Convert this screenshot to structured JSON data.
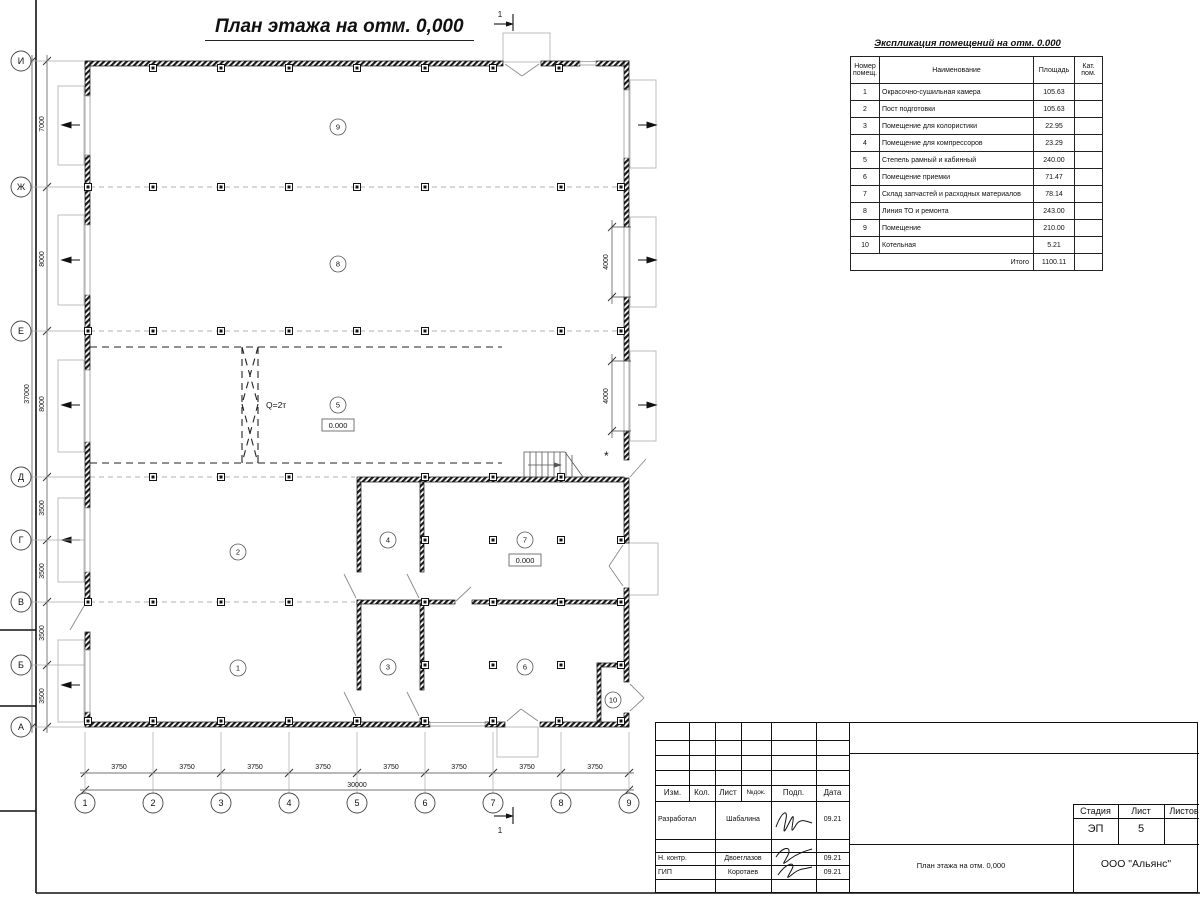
{
  "title": "План этажа на отм. 0,000",
  "section_mark": "1",
  "axes": {
    "left": [
      "И",
      "Ж",
      "Е",
      "Д",
      "Г",
      "В",
      "Б",
      "А"
    ],
    "bottom": [
      "1",
      "2",
      "3",
      "4",
      "5",
      "6",
      "7",
      "8",
      "9"
    ]
  },
  "dimensions": {
    "left_segments": [
      "7000",
      "8000",
      "8000",
      "3500",
      "3500",
      "3500",
      "3500"
    ],
    "left_total": "37000",
    "bottom_segments": [
      "3750",
      "3750",
      "3750",
      "3750",
      "3750",
      "3750",
      "3750",
      "3750"
    ],
    "bottom_total": "30000",
    "right_segments": [
      "4000",
      "4000"
    ]
  },
  "plan_labels": {
    "crane": "Q=2т",
    "level_marks": [
      "0.000",
      "0.000"
    ],
    "room_numbers": [
      "1",
      "2",
      "3",
      "4",
      "5",
      "6",
      "7",
      "8",
      "9",
      "10"
    ],
    "asterisk": "*"
  },
  "explication": {
    "title": "Экспликация помещений на отм. 0.000",
    "headers": [
      "Номер\nпомещ.",
      "Наименование",
      "Площадь",
      "Кат.\nпом."
    ],
    "rows": [
      {
        "num": "1",
        "name": "Окрасочно-сушильная камера",
        "area": "105.63"
      },
      {
        "num": "2",
        "name": "Пост подготовки",
        "area": "105.63"
      },
      {
        "num": "3",
        "name": "Помещение для колористики",
        "area": "22.95"
      },
      {
        "num": "4",
        "name": "Помещение для компрессоров",
        "area": "23.29"
      },
      {
        "num": "5",
        "name": "Степель рамный и кабинный",
        "area": "240.00"
      },
      {
        "num": "6",
        "name": "Помещение приемки",
        "area": "71.47"
      },
      {
        "num": "7",
        "name": "Склад запчастей и расходных материалов",
        "area": "78.14"
      },
      {
        "num": "8",
        "name": "Линия ТО и ремонта",
        "area": "243.00"
      },
      {
        "num": "9",
        "name": "Помещение",
        "area": "210.00"
      },
      {
        "num": "10",
        "name": "Котельная",
        "area": "5.21"
      }
    ],
    "total_label": "Итого",
    "total_value": "1100.11"
  },
  "title_block": {
    "header_cells": [
      "Изм.",
      "Кол.",
      "Лист",
      "№док.",
      "Подп.",
      "Дата"
    ],
    "rows": [
      {
        "role": "Разработал",
        "name": "Шабалина",
        "date": "09.21"
      },
      {
        "role": "Н. контр.",
        "name": "Двоеглазов",
        "date": "09.21"
      },
      {
        "role": "ГИП",
        "name": "Коротаев",
        "date": "09.21"
      }
    ],
    "stage_label": "Стадия",
    "sheet_label": "Лист",
    "sheets_label": "Листов",
    "stage_value": "ЭП",
    "sheet_value": "5",
    "doc_title": "План этажа на отм. 0,000",
    "company": "ООО \"Альянс\""
  }
}
